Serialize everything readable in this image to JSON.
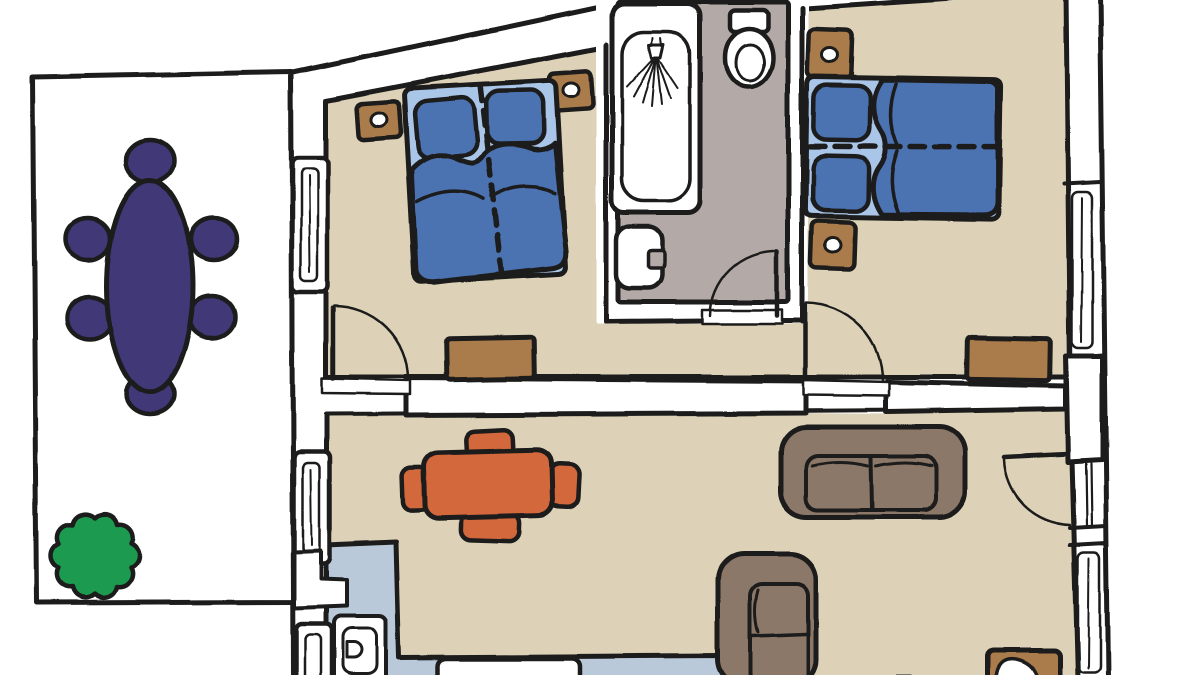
{
  "title": "Hand-drawn apartment floor plan",
  "palette": {
    "outline": "#1d1c1a",
    "wall_white": "#ffffff",
    "floor_beige": "#ddd2b8",
    "bathroom_gray": "#b3aaa7",
    "kitchen_blue": "#b9c9da",
    "bed_light_blue": "#a9c6e8",
    "bed_dark_blue": "#4b72b1",
    "wood_brown": "#ab7b4b",
    "sofa_brown": "#8b7869",
    "table_orange": "#d2673a",
    "dining_purple": "#3f3877",
    "plant_green": "#1d9a4f"
  },
  "scene": {
    "type": "floor-plan",
    "style": "hand-drawn cartoon illustration, thick black outlines, no text labels",
    "outdoor": {
      "name": "terrace",
      "floor": "white",
      "furniture": [
        "oval dining table (dark purple)",
        "6 round chairs (dark purple)",
        "green shrub"
      ]
    },
    "rooms": [
      {
        "name": "bedroom-1",
        "position": "top-left",
        "floor": "beige",
        "furniture": [
          "double bed (blue, two pillows, dashed center line)",
          "2 brown nightstands with lamps",
          "brown rug near door"
        ],
        "features": [
          "window on left wall",
          "door swinging from hallway wall"
        ]
      },
      {
        "name": "bathroom",
        "position": "top-center",
        "floor": "gray",
        "furniture": [
          "bathtub with shower",
          "toilet",
          "washbasin"
        ],
        "features": [
          "door at bottom wall"
        ]
      },
      {
        "name": "bedroom-2",
        "position": "top-right",
        "floor": "beige",
        "furniture": [
          "double bed (blue, two pillows, dashed center line)",
          "2 brown nightstands with lamps",
          "brown rug"
        ],
        "features": [
          "window on right wall",
          "door swinging from hallway wall"
        ]
      },
      {
        "name": "living-dining-room",
        "position": "bottom",
        "floor": "beige",
        "furniture": [
          "orange dining table with 4 chairs",
          "large brown sofa",
          "small brown sofa",
          "brown pet bed at bottom right"
        ],
        "features": [
          "entry door on right wall",
          "window on right wall"
        ]
      },
      {
        "name": "kitchenette",
        "position": "bottom-left",
        "floor": "light blue",
        "furniture": [
          "sink unit with faucet",
          "wall column appliance",
          "lower counter"
        ],
        "features": [
          "2 windows on left wall"
        ]
      }
    ],
    "counts": {
      "beds": 2,
      "nightstands": 4,
      "rugs": 2,
      "sofas": 2,
      "doors": 4,
      "windows": 5,
      "chairs_outdoor": 6,
      "chairs_dining": 4
    }
  }
}
